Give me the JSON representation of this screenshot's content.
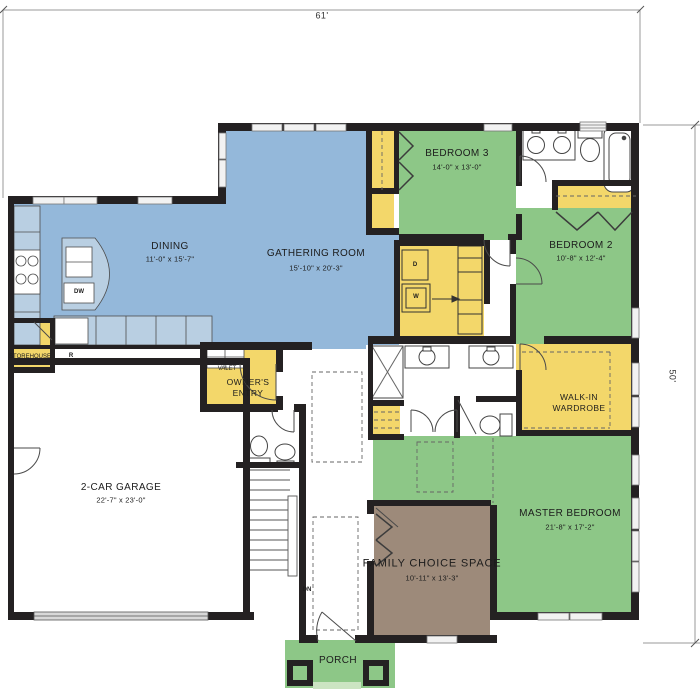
{
  "dimensions": {
    "width_label": "61'",
    "height_label": "50'"
  },
  "palette": {
    "living": "#94b8da",
    "bedroom": "#8dc787",
    "utility": "#f3d76a",
    "flex": "#9d8a7a",
    "porch": "#8dc787",
    "step": "#cbe4c2",
    "wall": "#242122",
    "counter": "#b9cfe2"
  },
  "rooms": {
    "dining": {
      "label": "DINING",
      "size": "11'-0\" x 15'-7\""
    },
    "gathering": {
      "label": "GATHERING ROOM",
      "size": "15'-10\" x 20'-3\""
    },
    "bedroom3": {
      "label": "BEDROOM 3",
      "size": "14'-0\" x 13'-0\""
    },
    "bedroom2": {
      "label": "BEDROOM 2",
      "size": "10'-8\" x 12'-4\""
    },
    "walk_in": {
      "line1": "WALK-IN",
      "line2": "WARDROBE"
    },
    "master": {
      "label": "MASTER BEDROOM",
      "size": "21'-8\" x 17'-2\""
    },
    "garage": {
      "label": "2-CAR GARAGE",
      "size": "22'-7\" x 23'-0\""
    },
    "family": {
      "label": "FAMILY CHOICE SPACE",
      "size": "10'-11\" x 13'-3\""
    },
    "porch": {
      "label": "PORCH"
    },
    "owners_entry": {
      "line1": "OWNER'S",
      "line2": "ENTRY"
    },
    "valet": {
      "label": "VALET"
    },
    "storehouse": {
      "label": "STOREHOUSE"
    }
  },
  "fixtures": {
    "dryer": "D",
    "washer": "W",
    "dishwasher": "DW",
    "refrigerator": "R",
    "stairs_down": "DN"
  }
}
